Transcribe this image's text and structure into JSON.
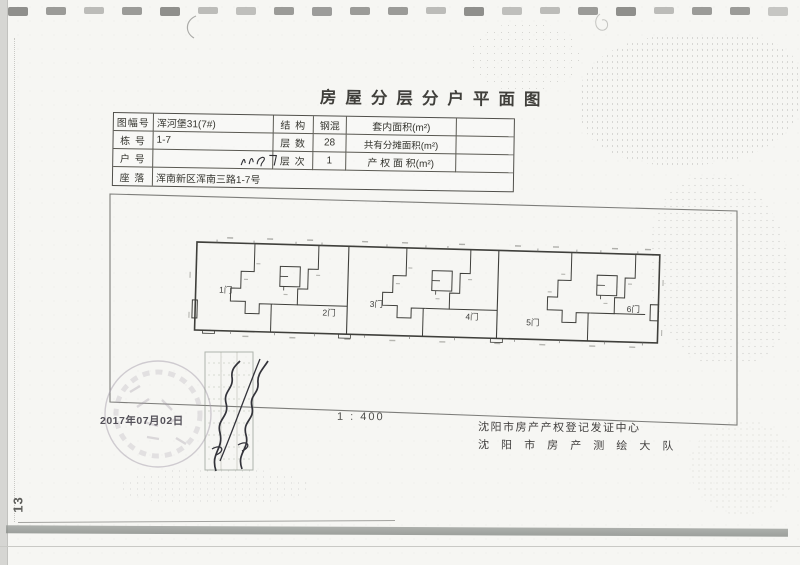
{
  "page": {
    "title": "房屋分层分户平面图"
  },
  "info_table": {
    "rows_left": [
      {
        "label": "图幅号",
        "value": "浑河堡31(7#)"
      },
      {
        "label": "栋  号",
        "value": "1-7"
      },
      {
        "label": "户  号",
        "value": ""
      },
      {
        "label": "座  落",
        "value": "浑南新区浑南三路1-7号"
      }
    ],
    "rows_right": [
      {
        "label": "结 构",
        "value": "钢混",
        "label2": "套内面积(m²)",
        "value2": ""
      },
      {
        "label": "层 数",
        "value": "28",
        "label2": "共有分摊面积(m²)",
        "value2": ""
      },
      {
        "label": "层 次",
        "value": "1",
        "label2": "产 权 面 积(m²)",
        "value2": ""
      }
    ]
  },
  "plan": {
    "units": [
      "1门",
      "2门",
      "3门",
      "4门",
      "5门",
      "6门"
    ],
    "scale_text": "1 : 400"
  },
  "footer": {
    "date": "2017年07月02日",
    "org_line1": "沈阳市房产产权登记发证中心",
    "org_line2": "沈 阳 市 房 产 测 绘 大 队",
    "page_number": "13"
  },
  "colors": {
    "wall": "#3f3f3b",
    "border": "#7d7d7a",
    "stamp": "#a89fad",
    "ink": "#33333a"
  }
}
